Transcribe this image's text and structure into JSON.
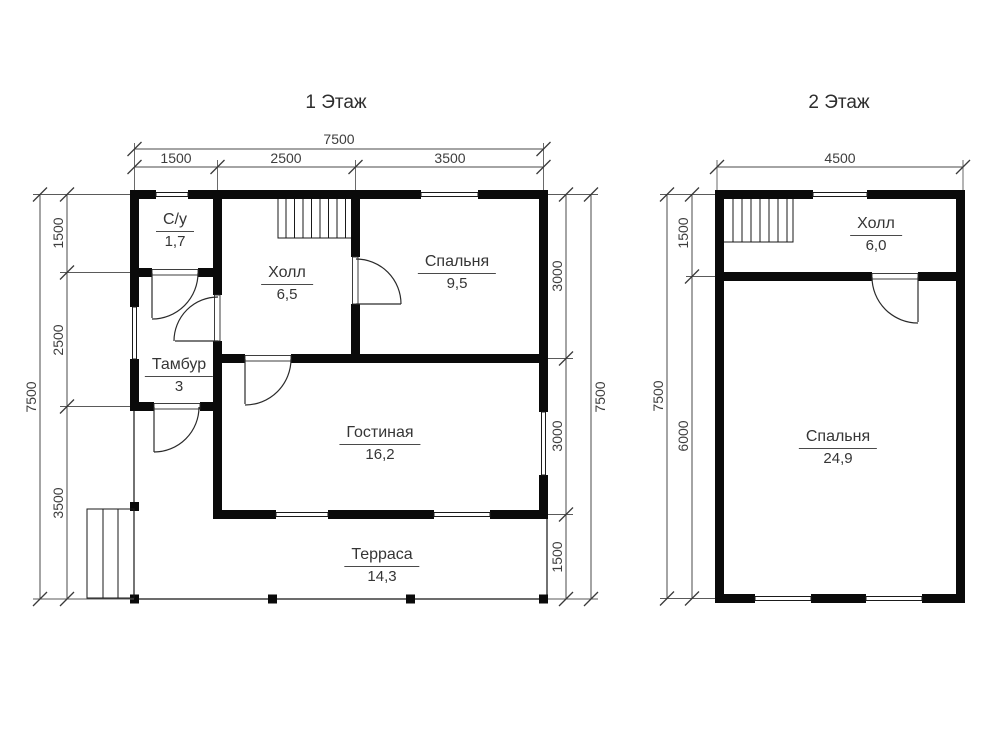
{
  "colors": {
    "wall": "#0a0a0a",
    "dim_line": "#4a4a4a",
    "text": "#353535",
    "background": "#ffffff"
  },
  "floor1": {
    "title": "1 Этаж",
    "rooms": [
      {
        "name": "С/у",
        "area": "1,7"
      },
      {
        "name": "Холл",
        "area": "6,5"
      },
      {
        "name": "Спальня",
        "area": "9,5"
      },
      {
        "name": "Тамбур",
        "area": "3"
      },
      {
        "name": "Гостиная",
        "area": "16,2"
      },
      {
        "name": "Терраса",
        "area": "14,3"
      }
    ],
    "dims": {
      "top_total": "7500",
      "top_segments": [
        "1500",
        "2500",
        "3500"
      ],
      "left_total": "7500",
      "left_segments": [
        "1500",
        "2500",
        "3500"
      ],
      "right_total": "7500",
      "right_segments": [
        "3000",
        "3000",
        "1500"
      ]
    }
  },
  "floor2": {
    "title": "2 Этаж",
    "rooms": [
      {
        "name": "Холл",
        "area": "6,0"
      },
      {
        "name": "Спальня",
        "area": "24,9"
      }
    ],
    "dims": {
      "top_total": "4500",
      "left_total": "7500",
      "left_segments": [
        "1500",
        "6000"
      ]
    }
  }
}
